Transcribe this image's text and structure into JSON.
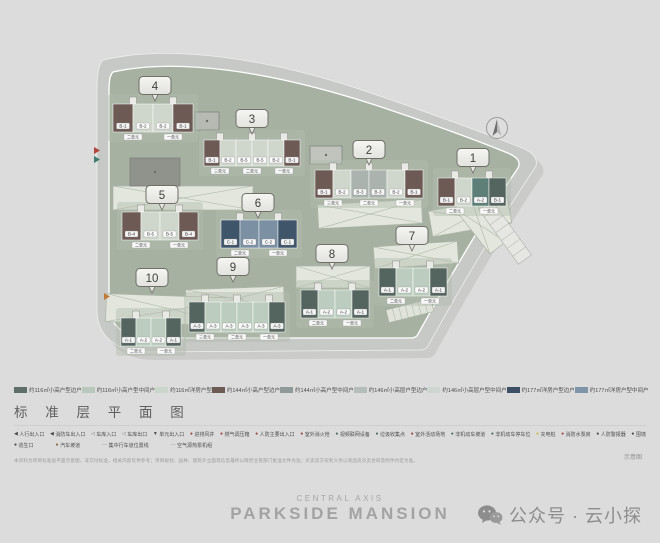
{
  "page": {
    "background": "#dcdcdc"
  },
  "section_title": "标 准 层 平 面 图",
  "plan": {
    "compass_icon": "compass-north-arrow",
    "buildings": [
      {
        "no": "4",
        "tags": [
          "二单元",
          "一单元"
        ],
        "units": [
          {
            "label": "B-1",
            "color": "#6d5a55"
          },
          {
            "label": "B-2",
            "color": "#cfd6cc"
          },
          {
            "label": "B-2",
            "color": "#cfd6cc"
          },
          {
            "label": "B-1",
            "color": "#6d5a55"
          }
        ]
      },
      {
        "no": "3",
        "tags": [
          "三单元",
          "二单元",
          "一单元"
        ],
        "units": [
          {
            "label": "B-1",
            "color": "#6d5a55"
          },
          {
            "label": "B-2",
            "color": "#cfd6cc"
          },
          {
            "label": "B-5",
            "color": "#cfd6cc"
          },
          {
            "label": "B-5",
            "color": "#cfd6cc"
          },
          {
            "label": "B-2",
            "color": "#cfd6cc"
          },
          {
            "label": "B-1",
            "color": "#6d5a55"
          }
        ]
      },
      {
        "no": "2",
        "tags": [
          "三单元",
          "二单元",
          "一单元"
        ],
        "units": [
          {
            "label": "B-1",
            "color": "#6d5a55"
          },
          {
            "label": "B-2",
            "color": "#cfd6cc"
          },
          {
            "label": "B-3",
            "color": "#aab3ad"
          },
          {
            "label": "B-3",
            "color": "#aab3ad"
          },
          {
            "label": "B-2",
            "color": "#cfd6cc"
          },
          {
            "label": "B-1",
            "color": "#6d5a55"
          }
        ]
      },
      {
        "no": "1",
        "tags": [
          "二单元",
          "一单元"
        ],
        "units": [
          {
            "label": "B-1",
            "color": "#6d5a55"
          },
          {
            "label": "B-2",
            "color": "#cfd6cc"
          },
          {
            "label": "A-2",
            "color": "#5d7f78"
          },
          {
            "label": "B-1",
            "color": "#54645f"
          }
        ]
      },
      {
        "no": "5",
        "tags": [
          "二单元",
          "一单元"
        ],
        "units": [
          {
            "label": "B-4",
            "color": "#6d5a55"
          },
          {
            "label": "B-5",
            "color": "#cfd6cc"
          },
          {
            "label": "B-5",
            "color": "#cfd6cc"
          },
          {
            "label": "B-4",
            "color": "#6d5a55"
          }
        ]
      },
      {
        "no": "6",
        "tags": [
          "二单元",
          "一单元"
        ],
        "units": [
          {
            "label": "C-1",
            "color": "#3f556a"
          },
          {
            "label": "C-2",
            "color": "#7b90a3"
          },
          {
            "label": "C-2",
            "color": "#7b90a3"
          },
          {
            "label": "C-1",
            "color": "#3f556a"
          }
        ]
      },
      {
        "no": "7",
        "tags": [
          "二单元",
          "一单元"
        ],
        "units": [
          {
            "label": "A-1",
            "color": "#54645f"
          },
          {
            "label": "A-2",
            "color": "#bccdbf"
          },
          {
            "label": "A-2",
            "color": "#bccdbf"
          },
          {
            "label": "A-1",
            "color": "#54645f"
          }
        ]
      },
      {
        "no": "8",
        "tags": [
          "二单元",
          "一单元"
        ],
        "units": [
          {
            "label": "A-1",
            "color": "#54645f"
          },
          {
            "label": "A-2",
            "color": "#bccdbf"
          },
          {
            "label": "A-2",
            "color": "#bccdbf"
          },
          {
            "label": "A-1",
            "color": "#54645f"
          }
        ]
      },
      {
        "no": "9",
        "tags": [
          "三单元",
          "二单元",
          "一单元"
        ],
        "units": [
          {
            "label": "A-3",
            "color": "#54645f"
          },
          {
            "label": "A-3",
            "color": "#bccdbf"
          },
          {
            "label": "A-3",
            "color": "#bccdbf"
          },
          {
            "label": "A-3",
            "color": "#bccdbf"
          },
          {
            "label": "A-3",
            "color": "#bccdbf"
          },
          {
            "label": "A-3",
            "color": "#54645f"
          }
        ]
      },
      {
        "no": "10",
        "tags": [
          "二单元",
          "一单元"
        ],
        "units": [
          {
            "label": "A-1",
            "color": "#54645f"
          },
          {
            "label": "A-2",
            "color": "#bccdbf"
          },
          {
            "label": "A-2",
            "color": "#bccdbf"
          },
          {
            "label": "A-1",
            "color": "#54645f"
          }
        ]
      }
    ]
  },
  "legend": {
    "row1": [
      {
        "color": "#5e6e69",
        "label": "约116㎡小高户型边户"
      },
      {
        "color": "#b9c8bc",
        "label": "约116㎡小高户型中间户"
      },
      {
        "color": "#cbd6cb",
        "label": "约116㎡洋房户型"
      },
      {
        "color": "#6d5a55",
        "label": "约144㎡小高户型边户"
      },
      {
        "color": "#8f9a99",
        "label": "约144㎡小高户型中间户"
      },
      {
        "color": "#b4bdb9",
        "label": "约146㎡小高层户型边户"
      },
      {
        "color": "#ced6d2",
        "label": "约146㎡小高层户型中间户"
      },
      {
        "color": "#3c4f63",
        "label": "约177㎡洋房户型边户"
      },
      {
        "color": "#7f94a6",
        "label": "约177㎡洋房户型中间户"
      }
    ],
    "row2": [
      {
        "symbol": "◀",
        "color": "#4a4a4a",
        "label": "人行出入口"
      },
      {
        "symbol": "◀",
        "color": "#4a4a4a",
        "label": "消防车出入口"
      },
      {
        "symbol": "◁",
        "color": "#7e7e7e",
        "label": "车库入口"
      },
      {
        "symbol": "◁",
        "color": "#7e7e7e",
        "label": "车库出口"
      },
      {
        "symbol": "▼",
        "color": "#4a4a4a",
        "label": "单元出入口"
      },
      {
        "symbol": "●",
        "color": "#9a4a3e",
        "label": "进排风井"
      },
      {
        "symbol": "●",
        "color": "#9a4a3e",
        "label": "燃气调压箱"
      },
      {
        "symbol": "●",
        "color": "#9a4a3e",
        "label": "人防主要出入口"
      },
      {
        "symbol": "●",
        "color": "#9a4a3e",
        "label": "室外消火栓"
      },
      {
        "symbol": "●",
        "color": "#4f6b64",
        "label": "视频联网设备"
      },
      {
        "symbol": "●",
        "color": "#4f6b64",
        "label": "垃圾收集点"
      },
      {
        "symbol": "●",
        "color": "#9a4a3e",
        "label": "室外活动场地"
      },
      {
        "symbol": "●",
        "color": "#4f6b64",
        "label": "非机动车坡道"
      },
      {
        "symbol": "●",
        "color": "#4f6b64",
        "label": "非机动车停车位"
      },
      {
        "symbol": "●",
        "color": "#cdbb4a",
        "label": "充电桩"
      },
      {
        "symbol": "●",
        "color": "#9a4a3e",
        "label": "消防水泵房"
      },
      {
        "symbol": "●",
        "color": "#4a4a4a",
        "label": "人防警报器"
      },
      {
        "symbol": "●",
        "color": "#4a4a4a",
        "label": "围墙"
      }
    ],
    "row3": [
      {
        "symbol": "●",
        "color": "#4a4a4a",
        "label": "逃生口"
      },
      {
        "symbol": "●",
        "color": "#8a6a3e",
        "label": "汽车坡道"
      },
      {
        "symbol": "—",
        "color": "#9aa49a",
        "label": "集中行车道位置线"
      },
      {
        "symbol": "—",
        "color": "#9aa49a",
        "label": "空气源热泵机组"
      }
    ],
    "disclaimer": "本资料为项目标准层平面示意图，非交付标准，相关内容仅供参考；项目规划、园林、建筑外立面等信息最终以政府主管部门批准文件为准；买卖双方权利义务以商品房买卖合同及附件约定为准。",
    "note": "示意图"
  },
  "footer": {
    "brand_top": "CENTRAL AXIS",
    "brand_main": "PARKSIDE MANSION",
    "wechat_icon": "wechat-logo",
    "wechat_label": "公众号 · 云小探"
  }
}
